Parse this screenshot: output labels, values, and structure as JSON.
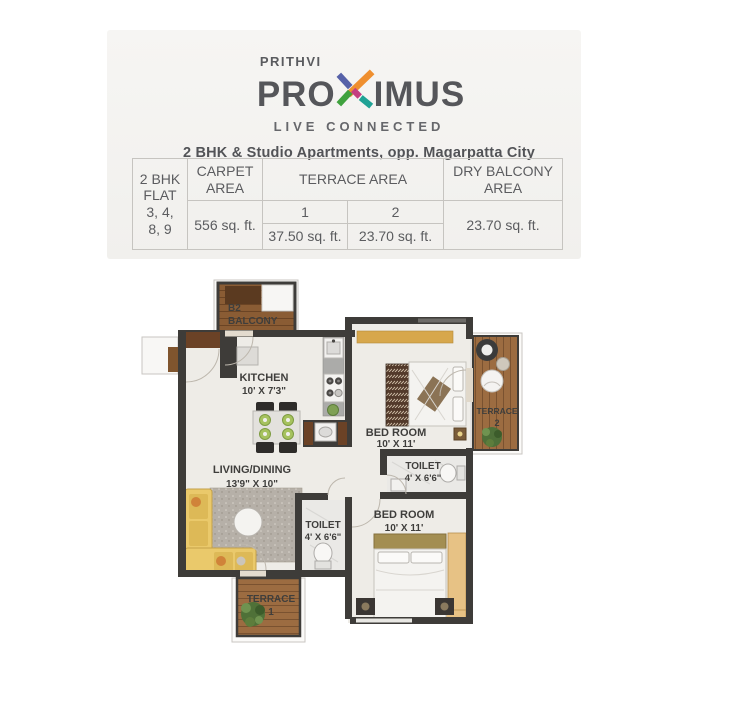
{
  "brand": {
    "name_top": "PRITHVI",
    "name_pre": "PRO",
    "name_post": "IMUS",
    "tagline": "LIVE CONNECTED",
    "subtitle": "2 BHK & Studio Apartments, opp. Magarpatta City",
    "x_colors": {
      "blue": "#5661a8",
      "orange": "#ef8f2f",
      "green": "#3fa23e",
      "teal": "#1fa295",
      "magenta": "#c43f80"
    },
    "text_gray": "#55565a"
  },
  "area_table": {
    "flat": "2 BHK\nFLAT\n3, 4,\n8, 9",
    "carpet": {
      "header": "CARPET\nAREA",
      "value": "556 sq. ft."
    },
    "terrace": {
      "header": "TERRACE AREA",
      "cols": [
        {
          "label": "1",
          "value": "37.50 sq. ft."
        },
        {
          "label": "2",
          "value": "23.70 sq. ft."
        }
      ]
    },
    "dry_balcony": {
      "header": "DRY BALCONY\nAREA",
      "value": "23.70 sq. ft."
    }
  },
  "floorplan": {
    "balcony": {
      "line1": "B2",
      "line2": "BALCONY"
    },
    "kitchen": {
      "name": "KITCHEN",
      "dims": "10' X 7'3\""
    },
    "living": {
      "name": "LIVING/DINING",
      "dims": "13'9\" X 10\""
    },
    "bedroom1": {
      "name": "BED ROOM",
      "dims": "10' X 11'"
    },
    "toilet1": {
      "name": "TOILET",
      "dims": "4' X 6'6\""
    },
    "bedroom2": {
      "name": "BED ROOM",
      "dims": "10' X 11'"
    },
    "toilet2": {
      "name": "TOILET",
      "dims": "4' X 6'6\""
    },
    "terrace1": {
      "line1": "TERRACE",
      "line2": "1"
    },
    "terrace2": {
      "line1": "TERRACE",
      "line2": "2"
    },
    "colors": {
      "wall": "#3e3c39",
      "wood_deck": "#9c6c41",
      "floor": "#eeece7",
      "sofa": "#eac96b",
      "wardrobe": "#e7c285"
    }
  }
}
